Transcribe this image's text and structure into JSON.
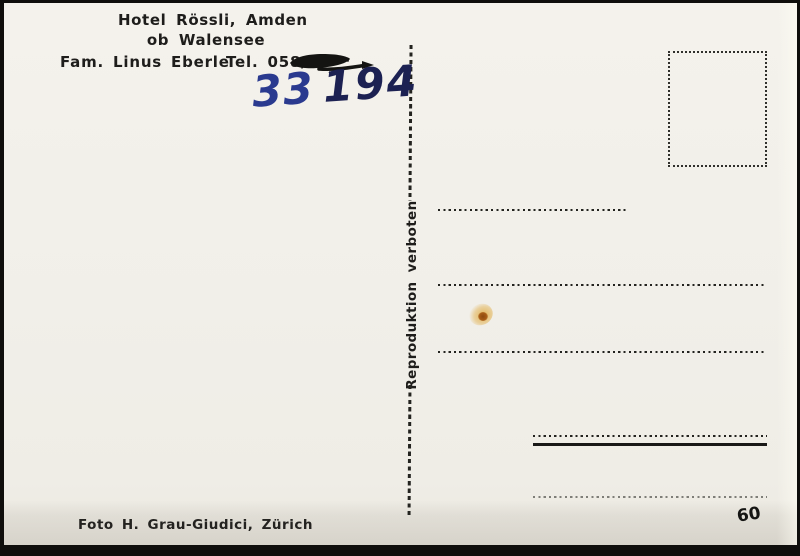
{
  "header": {
    "hotel_line1": "Hotel Rössli, Amden",
    "hotel_line2": "ob Walensee",
    "family_name": "Fam. Linus Eberle",
    "phone_label": "Tel. 058/"
  },
  "handwriting": {
    "digits_part1": "33",
    "digits_part2": "194"
  },
  "divider": {
    "vertical_text": "Reproduktion verboten"
  },
  "footer": {
    "photo_credit": "Foto H. Grau-Giudici, Zürich",
    "card_number": "60"
  },
  "colors": {
    "paper": "#f1efe9",
    "ink": "#1e1d1b",
    "frame": "#0f0e0c",
    "handwriting_blue": "#2a3a8f",
    "handwriting_dark": "#1c2152",
    "stain_outer": "#e0aa3e",
    "stain_core": "#8e4a10"
  }
}
